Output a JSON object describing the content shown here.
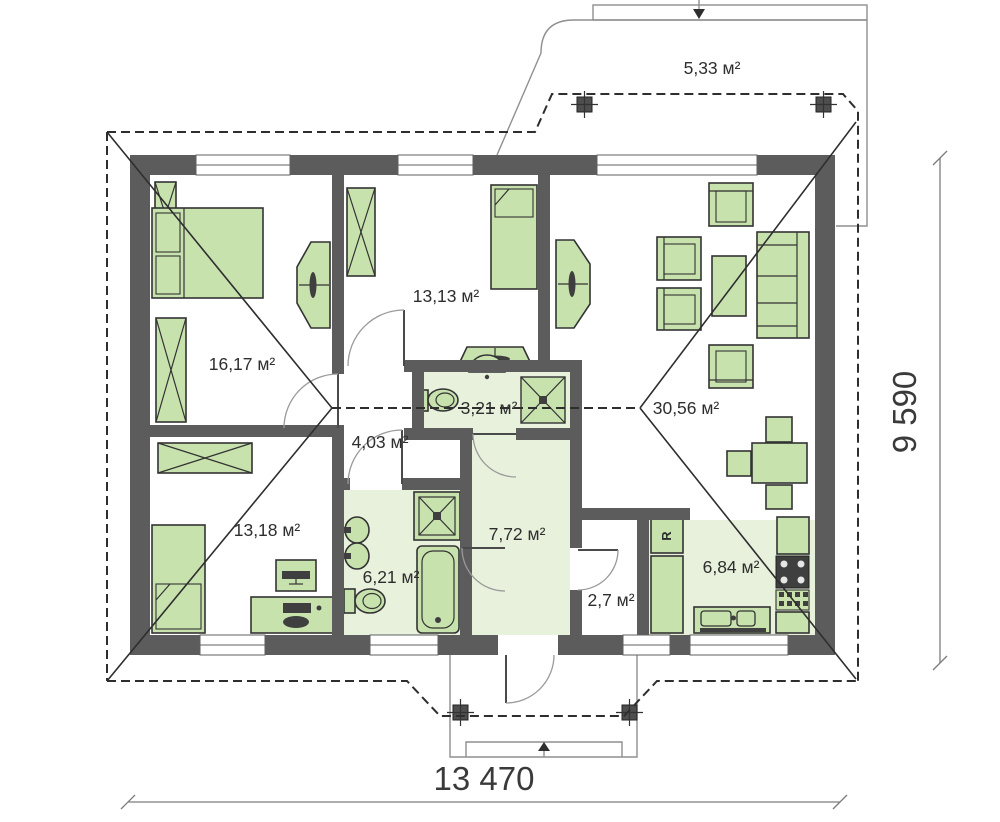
{
  "plan": {
    "rooms": [
      {
        "name": "terrace",
        "area": "5,33 м²"
      },
      {
        "name": "bedroom-1",
        "area": "16,17 м²"
      },
      {
        "name": "bedroom-2",
        "area": "13,13 м²"
      },
      {
        "name": "wc",
        "area": "3,21 м²"
      },
      {
        "name": "living-room",
        "area": "30,56 м²"
      },
      {
        "name": "hallway",
        "area": "4,03 м²"
      },
      {
        "name": "bedroom-3",
        "area": "13,18 м²"
      },
      {
        "name": "bathroom",
        "area": "6,21 м²"
      },
      {
        "name": "hall",
        "area": "7,72 м²"
      },
      {
        "name": "pantry",
        "area": "2,7 м²"
      },
      {
        "name": "kitchen",
        "area": "6,84 м²"
      }
    ],
    "dimensions": {
      "width_label": "13 470",
      "height_label": "9 590"
    },
    "fridge_label": "R",
    "colors": {
      "wall": "#5c5c5c",
      "furniture": "#c8e2ae",
      "floor_tint": "#e7f1dc",
      "roof_line": "#2e2e2e",
      "text": "#2e2e2e"
    }
  }
}
